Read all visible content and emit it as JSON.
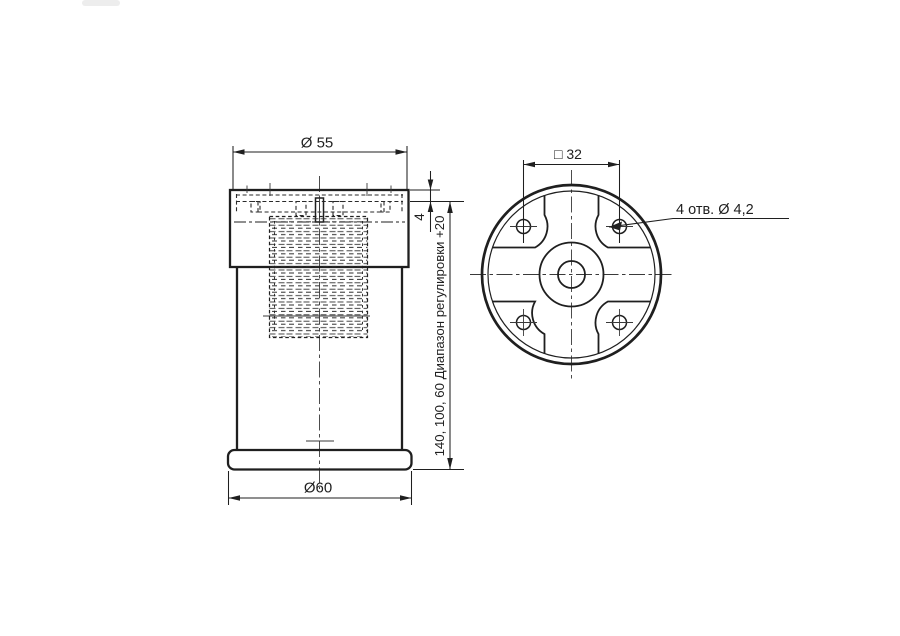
{
  "drawing": {
    "type": "technical-drawing",
    "colors": {
      "line": "#1f1f1f",
      "background": "#ffffff"
    },
    "side_view": {
      "dim_diameter_top": "Ø 55",
      "dim_diameter_bottom": "Ø60",
      "dim_plate_thickness": "4",
      "dim_height": "140,  100,  60  Диапазон регулировки +20"
    },
    "top_view": {
      "dim_square": "□ 32",
      "dim_holes": "4 отв. Ø 4,2"
    }
  }
}
